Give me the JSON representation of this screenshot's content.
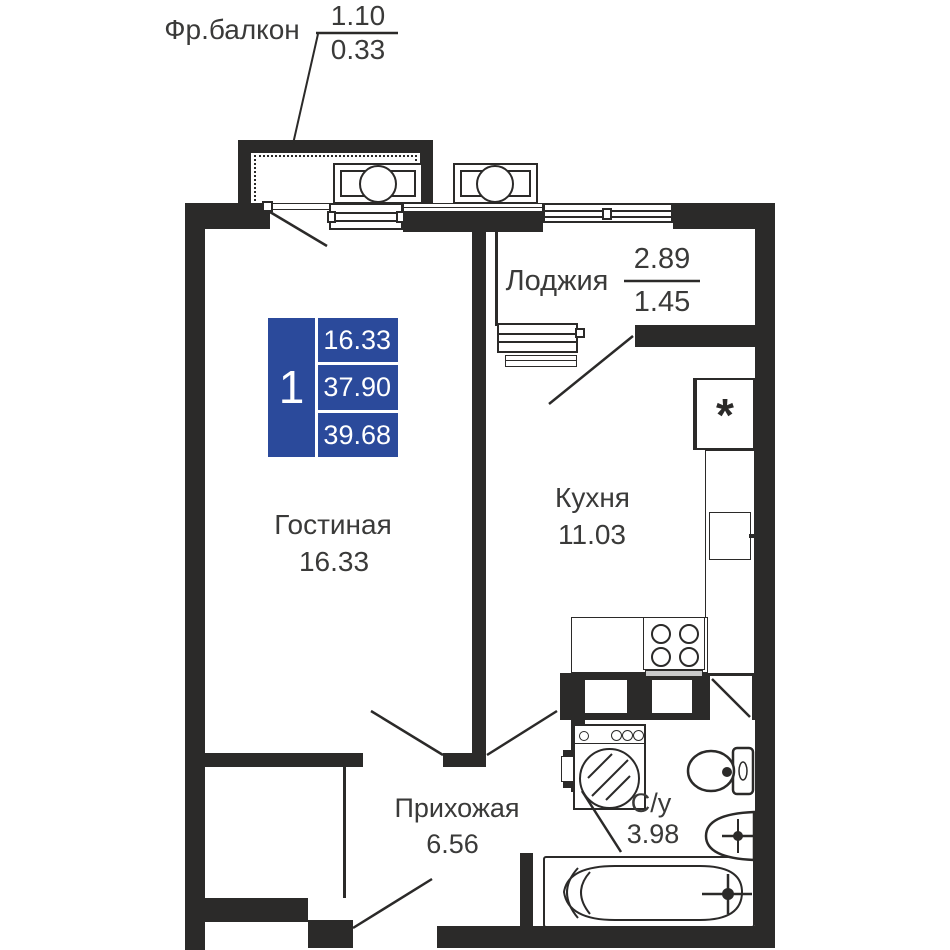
{
  "plan": {
    "title": "apartment-floor-plan",
    "colors": {
      "wall": "#2b2a29",
      "text": "#3a3a39",
      "legend_blue": "#2b4a9b"
    },
    "balcony": {
      "name": "Фр.балкон",
      "value_top": "1.10",
      "value_bottom": "0.33"
    },
    "loggia": {
      "name": "Лоджия",
      "value_top": "2.89",
      "value_bottom": "1.45"
    },
    "legend": {
      "rooms": "1",
      "rows": [
        "16.33",
        "37.90",
        "39.68"
      ]
    },
    "rooms": {
      "living": {
        "name": "Гостиная",
        "area": "16.33"
      },
      "kitchen": {
        "name": "Кухня",
        "area": "11.03"
      },
      "hall": {
        "name": "Прихожая",
        "area": "6.56"
      },
      "bathroom": {
        "name": "С/у",
        "area": "3.98"
      }
    },
    "symbols": {
      "fridge": "*"
    }
  }
}
